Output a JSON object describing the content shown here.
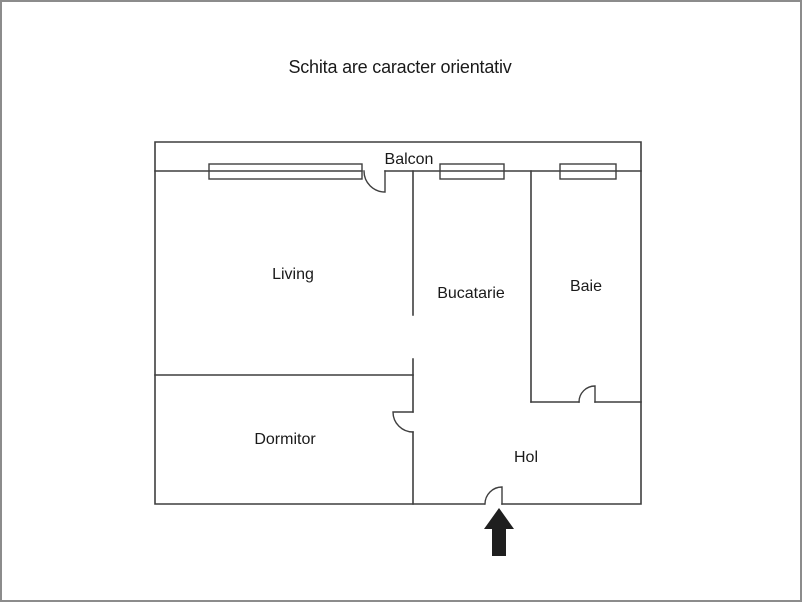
{
  "title": "Schita are caracter orientativ",
  "floor_plan": {
    "rooms": [
      {
        "id": "balcon",
        "label": "Balcon"
      },
      {
        "id": "living",
        "label": "Living"
      },
      {
        "id": "bucatarie",
        "label": "Bucatarie"
      },
      {
        "id": "baie",
        "label": "Baie"
      },
      {
        "id": "dormitor",
        "label": "Dormitor"
      },
      {
        "id": "hol",
        "label": "Hol"
      }
    ],
    "windows_count": 3,
    "door_arcs_count": 4,
    "entrance_marker": "arrow-up"
  },
  "colors": {
    "wall": "#3f3f3f",
    "text": "#1a1a1a",
    "arrow": "#1f1f1f",
    "page_border": "#8c8c8c",
    "background": "#ffffff"
  }
}
